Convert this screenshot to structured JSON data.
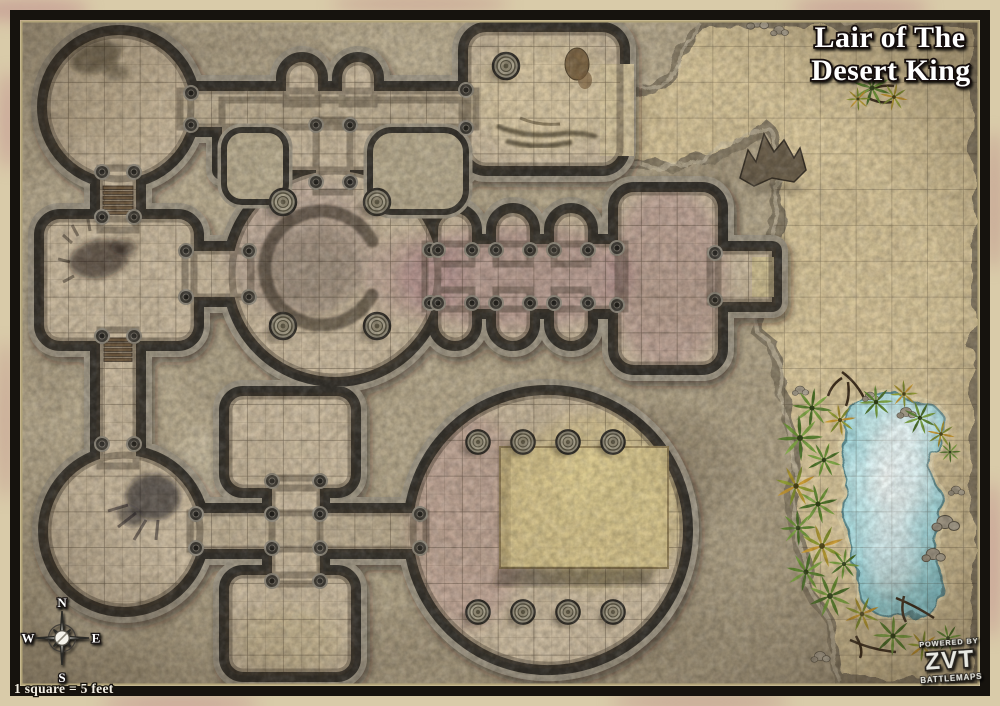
{
  "map": {
    "title_line1": "Lair of The",
    "title_line2": "Desert King",
    "scale_label": "1 square = 5 feet"
  },
  "compass": {
    "north": "N",
    "east": "E",
    "south": "S",
    "west": "W"
  },
  "logo": {
    "powered_by": "POWERED BY",
    "brand": "ZVT",
    "product": "BATTLEMAPS"
  },
  "grid": {
    "feet_per_square": 5
  },
  "icons": {
    "compass": "compass-rose-icon",
    "palm": "palm-plant-icon",
    "pillar": "pillar-icon",
    "boulder": "boulder-icon"
  },
  "palette": {
    "parchment": "#d9cba9",
    "frame": "#16130e",
    "rock": "#b9ac90",
    "sand": "#d7c59a",
    "dungeon_floor": "#c9b99e",
    "wall_dark": "#34312b",
    "wall_light": "#9e9685",
    "water": "#aee2e8",
    "foliage_green": "#6f9639",
    "accent_pink": "#9b6f7e",
    "accent_gold": "#d8c36c"
  }
}
